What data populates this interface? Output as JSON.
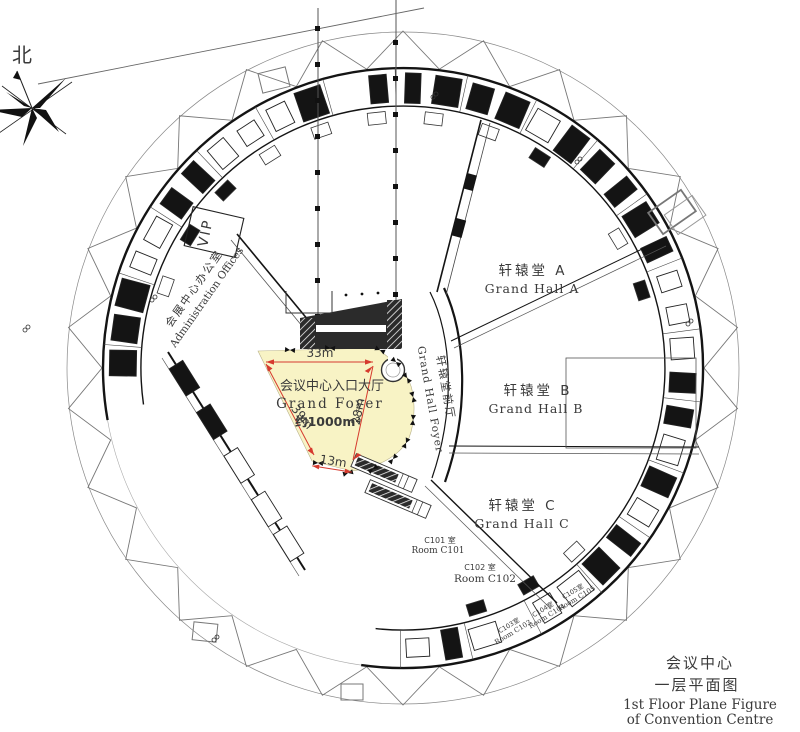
{
  "compass": {
    "north": "北"
  },
  "foyer": {
    "name_zh": "会议中心入口大厅",
    "name_en": "Grand Foyer",
    "area": "约1000m²",
    "fill": "#f8f3c5",
    "dim_color": "#d63a2e",
    "dims": {
      "top": "33m",
      "left": "39m",
      "right": "28m",
      "bottom": "13m"
    }
  },
  "halls": [
    {
      "zh": "轩辕堂 A",
      "en": "Grand Hall A"
    },
    {
      "zh": "轩辕堂 B",
      "en": "Grand Hall B"
    },
    {
      "zh": "轩辕堂 C",
      "en": "Grand Hall C"
    }
  ],
  "hall_foyer": {
    "zh": "轩辕堂前厅",
    "en": "Grand Hall Foyer"
  },
  "offices": {
    "zh": "会展中心办公室",
    "en": "Administration Offices"
  },
  "vip": {
    "label": "VIP"
  },
  "rooms": {
    "c101_zh": "C101 室",
    "c101_en": "Room C101",
    "c102_zh": "C102 室",
    "c102_en": "Room C102",
    "c103_zh": "C103室",
    "c103_en": "Room C103",
    "c104_zh": "C104室",
    "c104_en": "Room C104",
    "c105_zh": "C105室",
    "c105_en": "Room C105"
  },
  "caption": {
    "zh1": "会议中心",
    "zh2": "一层平面图",
    "en1": "1st Floor Plane Figure",
    "en2": "of Convention Centre"
  }
}
